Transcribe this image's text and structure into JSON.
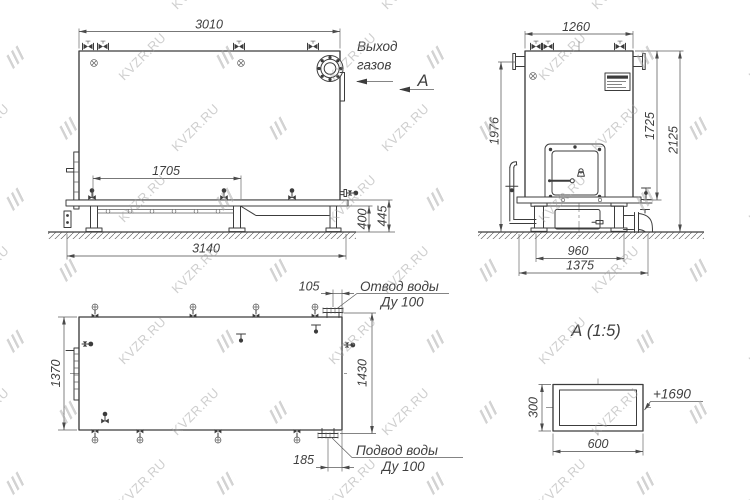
{
  "watermark": {
    "text": "KVZR.RU"
  },
  "drawing": {
    "flue_label": {
      "line1": "Выход",
      "line2": "газов"
    },
    "view_arrow": {
      "label": "А"
    },
    "side_view": {
      "dims": {
        "top_width": "3010",
        "support_span": "1705",
        "base_length": "3140",
        "base_height": "400",
        "ledge_height": "445"
      }
    },
    "front_view": {
      "dims": {
        "top_width": "1260",
        "left_height": "1976",
        "body_height": "1725",
        "total_height": "2125",
        "base_width": "960",
        "base_overall": "1375"
      }
    },
    "top_view": {
      "dims": {
        "depth": "1370",
        "outlet_offset": "105",
        "ports_span": "1430",
        "inlet_offset": "185"
      },
      "outlet_label": {
        "line1": "Отвод воды",
        "line2": "Ду 100"
      },
      "inlet_label": {
        "line1": "Подвод воды",
        "line2": "Ду 100"
      }
    },
    "detail_view": {
      "title": "А  (1:5)",
      "dims": {
        "height": "300",
        "width": "600",
        "elevation": "+1690"
      }
    }
  }
}
